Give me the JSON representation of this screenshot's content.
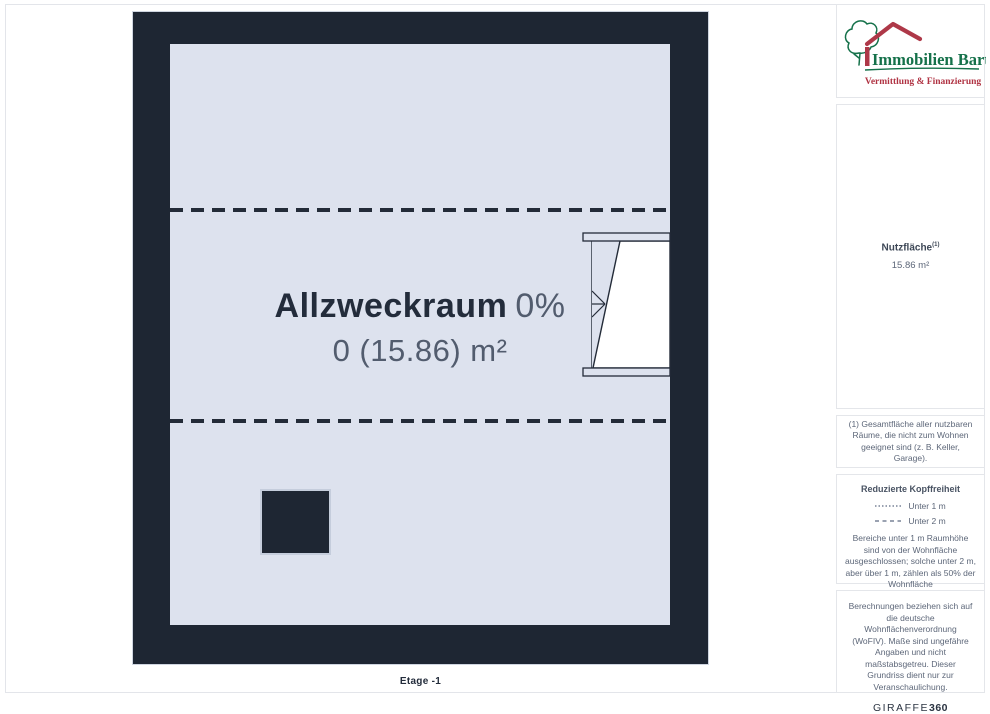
{
  "logo": {
    "name": "Immobilien Bart",
    "tagline": "Vermittlung & Finanzierung",
    "green": "#15714a",
    "red": "#ae3848"
  },
  "floorplan": {
    "room": {
      "name": "Allzweckraum",
      "percent": "0%",
      "area_line": "0 (15.86) m²"
    },
    "floor_label": "Etage -1"
  },
  "sidebar": {
    "area_label": "Nutzfläche",
    "area_superscript": "(1)",
    "area_value": "15.86 m²",
    "footnote": "(1) Gesamtfläche aller nutzbaren Räume, die nicht zum Wohnen geeignet sind (z. B. Keller, Garage).",
    "legend": {
      "title": "Reduzierte Kopffreiheit",
      "items": [
        {
          "label": "Unter 1 m",
          "line_style": "dotted"
        },
        {
          "label": "Unter 2 m",
          "line_style": "dashed"
        }
      ],
      "note": "Bereiche unter 1 m Raumhöhe sind von der Wohnfläche ausgeschlossen; solche unter 2 m, aber über 1 m, zählen als 50% der Wohnfläche"
    },
    "disclaimer": "Berechnungen beziehen sich auf die deutsche Wohnflächenverordnung (WoFIV). Maße sind ungefähre Angaben und nicht maßstabsgetreu. Dieser Grundriss dient nur zur Veranschaulichung.",
    "brand": {
      "word": "GIRAFFE",
      "number": "360"
    }
  },
  "colors": {
    "wall": "#1e2633",
    "room_fill": "#dde2ee",
    "text_dark": "#232c3b",
    "text_gray": "#5d6779"
  }
}
